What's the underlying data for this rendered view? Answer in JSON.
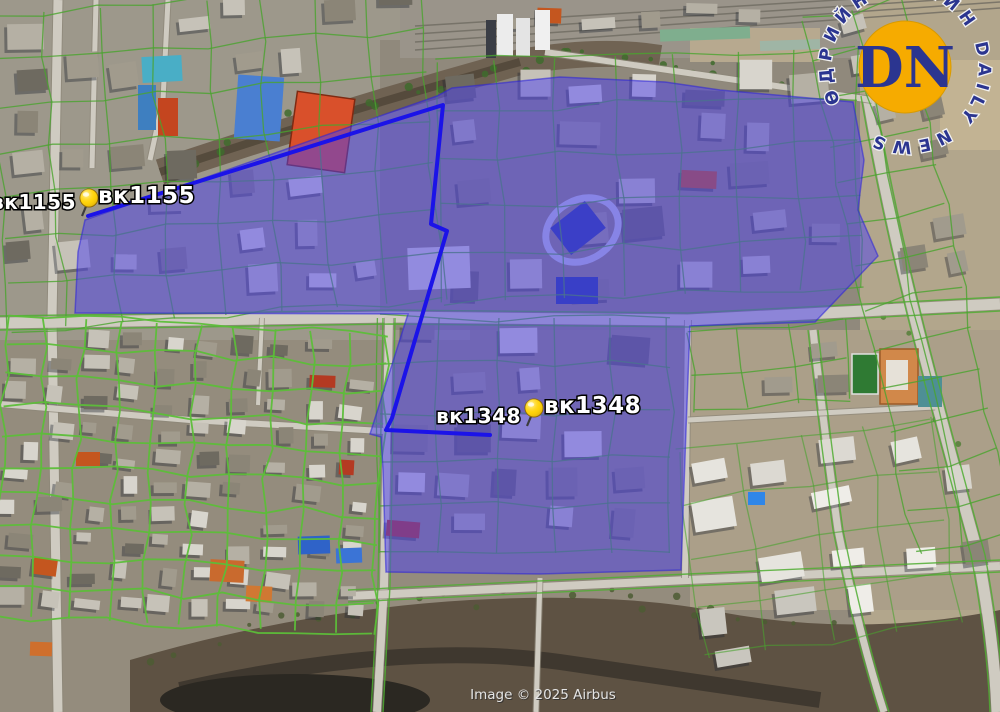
{
  "map": {
    "attribution": "Image © 2025 Airbus",
    "markers": [
      {
        "name": "вк1155",
        "label_left": "вк1155",
        "label_right": "вк1155"
      },
      {
        "name": "вк1348",
        "label_left": "вк1348",
        "label_right": "вк1348"
      }
    ],
    "overlay": {
      "fill_color": "#4b40f0",
      "outline_color": "#1b13e8",
      "pin_color": "#ffd400"
    }
  },
  "logo": {
    "monogram": "DN",
    "ring_text": "ӨДРИЙН СОНИН DAILY NEWS",
    "circle_color": "#f6ab00",
    "letter_color": "#2b3590"
  }
}
